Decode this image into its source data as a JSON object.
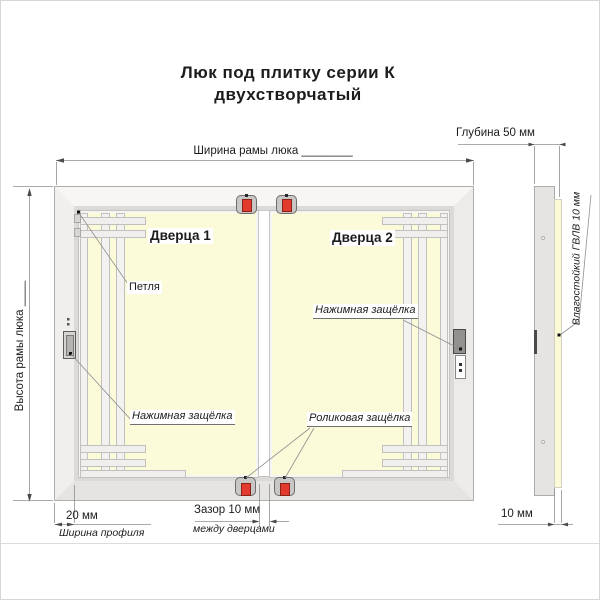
{
  "title": {
    "line1": "Люк под плитку серии К",
    "line2": "двухстворчатый"
  },
  "front_view": {
    "door1_label": "Дверца 1",
    "door2_label": "Дверца 2",
    "hinge_callout": "Петля",
    "door1_latch_callout": "Нажимная защёлка",
    "door2_latch_callout": "Нажимная защёлка",
    "roller_latch_callout": "Роликовая защёлка",
    "width_dim": "Ширина рамы люка ________",
    "height_dim": "Высота рамы люка ____",
    "profile_width_value": "20 мм",
    "profile_width_caption": "Ширина профиля",
    "gap_value": "Зазор 10 мм",
    "gap_caption": "между дверцами"
  },
  "side_view": {
    "depth_dim": "Глубина 50 мм",
    "panel_callout": "Влагостойкий ГВЛВ 10 мм",
    "panel_thickness": "10 мм"
  },
  "colors": {
    "door_fill": "#fbfbd9",
    "latch_red": "#e23b2e",
    "frame_gray": "#e6e4e2",
    "line_gray": "#8f8f8f",
    "text": "#1c1c1c"
  }
}
